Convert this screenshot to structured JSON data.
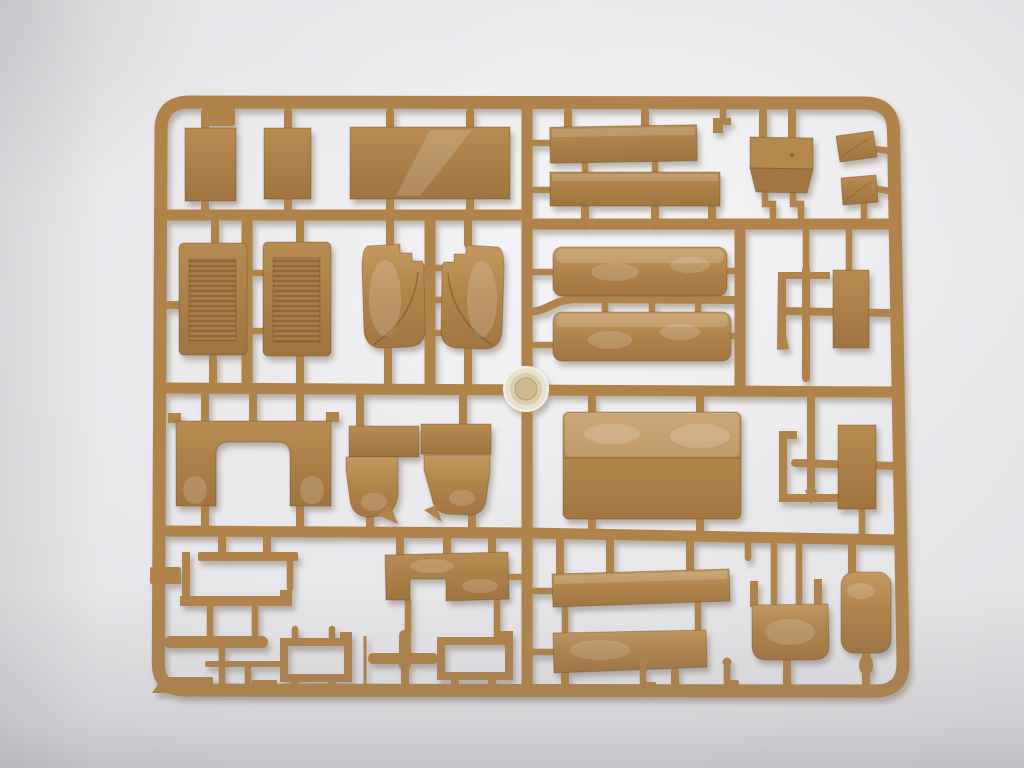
{
  "scene": {
    "type": "photograph",
    "subject": "Tan injection-molded plastic model kit sprue (parts tree) with rounded rectangular runner frame, photographed on a plain light-gray backdrop",
    "plastic_finish": "matte tan styrene with glossy sheen highlights",
    "injection_hub": "round shiny injection gate hub at the center of the crossing runners",
    "colors": {
      "c-bg-light": "#f1f1f3",
      "c-bg-mid": "#e0e0e3",
      "c-bg-dark": "#c4c5c9",
      "c-sprue": "#b0834a",
      "c-part": "#ab7e46",
      "c-part-light": "#c0955c",
      "c-part-dark": "#956d3c",
      "c-louver": "#8d6639",
      "c-hub-outer": "#e8e2d1",
      "c-hub-mid": "#d9cdaa",
      "c-hub-inner": "#cdb98b",
      "c-shadow": "rgba(95,80,55,0.38)"
    },
    "parts_inventory": [
      {
        "name": "small flat rectangular panel",
        "count": 2
      },
      {
        "name": "wide flat rectangular panel",
        "count": 1
      },
      {
        "name": "long flat strip panel",
        "count": 2
      },
      {
        "name": "folded equipment box",
        "count": 1
      },
      {
        "name": "small angled plate",
        "count": 2
      },
      {
        "name": "louvered engine side panel",
        "count": 2
      },
      {
        "name": "curved fender shell with stepped edge",
        "count": 2
      },
      {
        "name": "cab rear panel with rounded door opening",
        "count": 1
      },
      {
        "name": "front fender pair with flanges",
        "count": 1
      },
      {
        "name": "long cargo-bed side box",
        "count": 2
      },
      {
        "name": "large folded hull panel",
        "count": 1
      },
      {
        "name": "thin L-bracket and channel bracket",
        "count": 2
      },
      {
        "name": "small rectangular side panel",
        "count": 2
      },
      {
        "name": "open window frame",
        "count": 2
      },
      {
        "name": "thin chassis strips and bars",
        "count": 6
      },
      {
        "name": "notched floor plate",
        "count": 1
      },
      {
        "name": "bucket seat shell",
        "count": 1
      },
      {
        "name": "rounded door panel",
        "count": 1
      },
      {
        "name": "small pin with ball head",
        "count": 2
      }
    ]
  }
}
